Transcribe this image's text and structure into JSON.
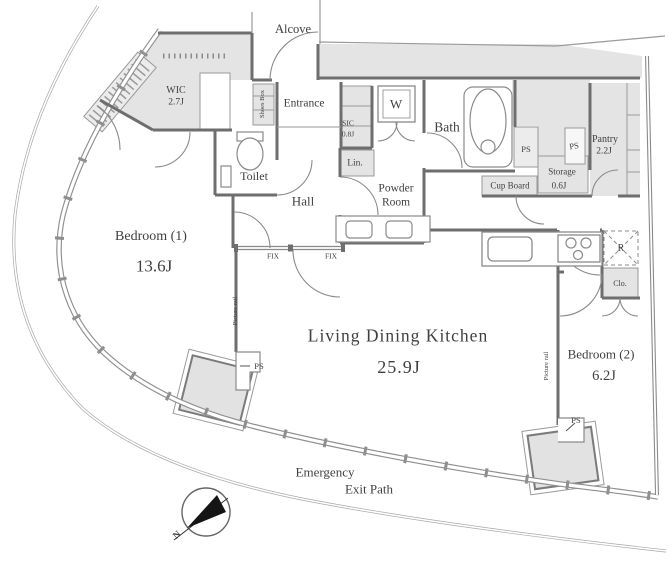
{
  "plan": {
    "alcove": "Alcove",
    "wic": {
      "label": "WIC",
      "size": "2.7J"
    },
    "shoes_box": "Shoes Box",
    "entrance": "Entrance",
    "toilet": "Toilet",
    "hall": "Hall",
    "sic": {
      "label": "SIC",
      "size": "0.8J"
    },
    "washer": "W",
    "bath": "Bath",
    "linen": "Lin.",
    "powder_room": {
      "line1": "Powder",
      "line2": "Room"
    },
    "pantry": {
      "label": "Pantry",
      "size": "2.2J"
    },
    "storage": {
      "label": "Storage",
      "size": "0.6J"
    },
    "cup_board": "Cup Board",
    "refrigerator": "R",
    "closet": "Clo.",
    "bedroom1": {
      "label": "Bedroom (1)",
      "size": "13.6J"
    },
    "bedroom2": {
      "label": "Bedroom (2)",
      "size": "6.2J"
    },
    "ldk": {
      "label": "Living Dining Kitchen",
      "size": "25.9J"
    },
    "fix": "FIX",
    "ps": "PS",
    "picture_rail": "Picture rail",
    "emergency": {
      "line1": "Emergency",
      "line2": "Exit Path"
    },
    "compass_north": "N"
  },
  "colors": {
    "wall": "#6e6e6e",
    "gray_fill": "#e4e4e4",
    "text": "#3f3f3f",
    "needle": "#151515"
  }
}
